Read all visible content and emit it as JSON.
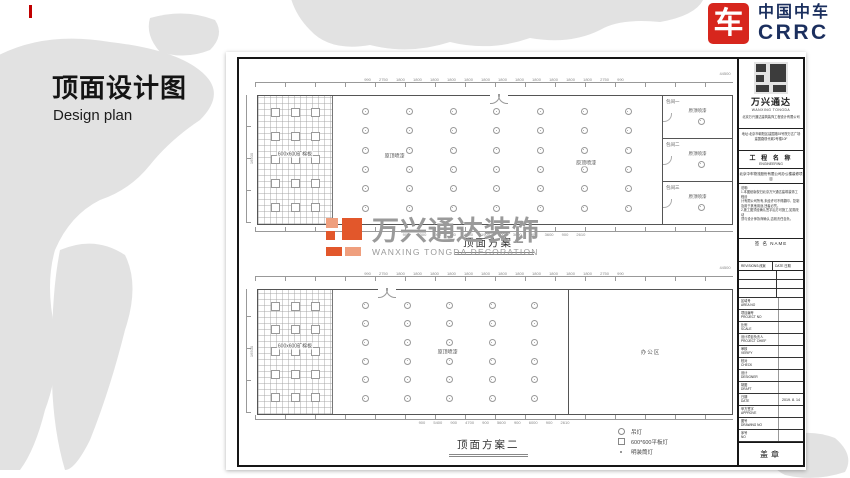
{
  "slide": {
    "title": "顶面设计图",
    "subtitle": "Design plan"
  },
  "brand": {
    "icon_char": "车",
    "name_cn": "中国中车",
    "name_en": "CRRC",
    "red": "#d7261d",
    "navy": "#1b2f5e"
  },
  "watermark": {
    "text": "万兴通达装饰",
    "subtext": "WANXING TONGDA DECORATION",
    "orange": "#e2572b"
  },
  "legend": {
    "items": [
      {
        "symbol": "pendant",
        "label": "吊灯"
      },
      {
        "symbol": "panel",
        "label": "600*600平板灯"
      },
      {
        "symbol": "downlight",
        "label": "明装筒灯"
      }
    ]
  },
  "plans": [
    {
      "caption": "顶面方案一",
      "top_dims": "990 2750 1800 1800 1800 1800 1800 1800 1800 1800 1800 1800 1800 1800 2750 990",
      "total": "44500",
      "side_dim": "16500",
      "bottom_dims": "900 6300 900 760 4700 1900 900 3600 900 3600 900 2610",
      "grid_label": "600x600矿棉板",
      "open_labels": [
        "原顶喷漆",
        "原顶喷漆"
      ],
      "lights": {
        "rows": 6,
        "cols": 7
      },
      "panels": {
        "rows": 5,
        "cols": 3
      },
      "rooms": [
        {
          "name": "包间一",
          "label": "原顶喷漆"
        },
        {
          "name": "包间二",
          "label": "原顶喷漆"
        },
        {
          "name": "包间三",
          "label": "原顶喷漆"
        }
      ]
    },
    {
      "caption": "顶面方案二",
      "top_dims": "990 2750 1800 1800 1800 1800 1800 1800 1800 1800 1800 1800 1800 1800 2750 990",
      "total": "44500",
      "side_dim": "16500",
      "bottom_dims": "900 5400 900 4700 900 5600 900 6000 900 2610",
      "grid_label": "600x600矿棉板",
      "open_labels": [
        "原顶喷漆"
      ],
      "lights": {
        "rows": 6,
        "cols": 5
      },
      "panels": {
        "rows": 5,
        "cols": 3
      },
      "office_label": "办公区"
    }
  ],
  "titleblock": {
    "logo_cn": "万兴通达",
    "logo_en": "WANXING TONGDA",
    "company": "北京万兴通达建筑装饰工程设计有限公司",
    "address_line1": "地址:北京市朝阳区建国路93号院万达广场",
    "address_line2": "建国路现代城2号楼10F",
    "project_header_cn": "工 程 名 称",
    "project_header_en": "ENGINEERING",
    "project_name": "北京中车物流股份有限公司办公楼装修项目",
    "notes_title": "说明:",
    "notes": [
      "1.本图纸版权归北京万兴通达建筑装饰工程设",
      "计有限公司所有,未经许可不得翻印、复制",
      "及用于其他用途,违者必究。",
      "2.施工图须经确认签字后方可施工,如需改动",
      "须与设计师协商确认,否则责任自负。"
    ],
    "sign_label": "签 名  NAME",
    "rev_header": "REVISIONS:改案",
    "rev_date": "DATE 日期",
    "fields": [
      {
        "cn": "区域号",
        "en": "AREA NO",
        "value": ""
      },
      {
        "cn": "项目编号",
        "en": "PROJECT NO",
        "value": ""
      },
      {
        "cn": "比例",
        "en": "SCALE",
        "value": ""
      },
      {
        "cn": "设计项目负责人",
        "en": "PROJECT CHIEF",
        "value": ""
      },
      {
        "cn": "审核",
        "en": "VERIFY",
        "value": ""
      },
      {
        "cn": "校对",
        "en": "CHECK",
        "value": ""
      },
      {
        "cn": "设计",
        "en": "DESIGNER",
        "value": ""
      },
      {
        "cn": "制图",
        "en": "DRAFT",
        "value": ""
      },
      {
        "cn": "日期",
        "en": "DATE",
        "value": "2019. 8. 14"
      },
      {
        "cn": "甲方签字",
        "en": "APPROVE",
        "value": ""
      },
      {
        "cn": "图号",
        "en": "DRAWING NO",
        "value": ""
      },
      {
        "cn": "序号",
        "en": "NO",
        "value": ""
      }
    ],
    "seal": "盖章"
  }
}
